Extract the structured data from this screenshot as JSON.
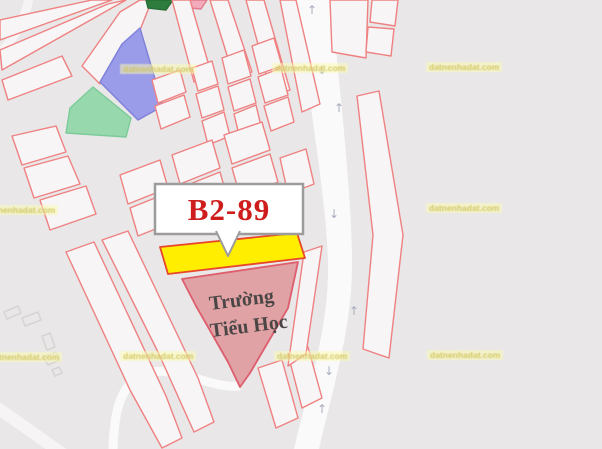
{
  "map": {
    "background_color": "#e9e7e8",
    "parcel_fill": "#f7f5f6",
    "parcel_stroke": "#ef8181",
    "road_color": "#fbfafb",
    "labels": {
      "plot_label": {
        "text": "B2-89",
        "color": "#ce1d1c",
        "box_border_color": "#9c9c9c"
      },
      "school_label": {
        "line1": "Trường",
        "line2": "Tiểu Học",
        "color": "#4b4646"
      }
    },
    "highlight_colors": {
      "selected_parcel_yellow": "#ffee00",
      "school_parcel_pink": "#e0a2a4",
      "parcel_blue": "#9a9be9",
      "parcel_green": "#97d8ac",
      "parcel_dark_green": "#2e7d3e",
      "parcel_pink_sliver": "#f3aabb"
    },
    "arrow_color": "#a8adbe",
    "arrows": [
      {
        "x": 312,
        "y": 14,
        "g": "↑"
      },
      {
        "x": 322,
        "y": 74,
        "g": "↓"
      },
      {
        "x": 339,
        "y": 112,
        "g": "↑"
      },
      {
        "x": 334,
        "y": 218,
        "g": "↓"
      },
      {
        "x": 354,
        "y": 315,
        "g": "↑"
      },
      {
        "x": 329,
        "y": 375,
        "g": "↓"
      },
      {
        "x": 322,
        "y": 413,
        "g": "↑"
      }
    ],
    "watermark": {
      "text": "datnenhadat.com",
      "color": "rgba(206,196,90,0.9)",
      "background": "rgba(252,250,178,0.55)",
      "positions": [
        {
          "x": 120,
          "y": 64
        },
        {
          "x": 272,
          "y": 63
        },
        {
          "x": 426,
          "y": 62
        },
        {
          "x": -18,
          "y": 205
        },
        {
          "x": 426,
          "y": 203
        },
        {
          "x": -14,
          "y": 352
        },
        {
          "x": 120,
          "y": 351
        },
        {
          "x": 274,
          "y": 351
        },
        {
          "x": 427,
          "y": 350
        }
      ]
    },
    "shapes": [
      {
        "name": "road-main",
        "d": "M297,0 L331,0 C341,100 353,210 352,270 C351,333 331,395 319,449 L294,449 C307,392 327,336 328,273 C329,212 308,100 297,0 Z",
        "fill": "#fbfafb",
        "stroke": "none",
        "w": 0,
        "i": false
      },
      {
        "name": "road-curvy",
        "d": "M240,386 C210,390 168,360 140,376 C118,388 114,418 113,449",
        "fill": "none",
        "stroke": "#fbfafb",
        "w": 9,
        "i": false
      },
      {
        "name": "road-bottom-left",
        "d": "M-8,404 L66,456",
        "fill": "none",
        "stroke": "#f6f4f5",
        "w": 12,
        "i": false
      },
      {
        "name": "road-top-left",
        "d": "M-8,62 C12,42 26,22 30,-8",
        "fill": "none",
        "stroke": "#f6f4f5",
        "w": 9,
        "i": false
      },
      {
        "name": "parcel-strip",
        "points": "0,20 92,0 112,0 0,40",
        "i": true
      },
      {
        "name": "parcel-strip",
        "points": "0,50 108,4 126,0 2,70",
        "i": true
      },
      {
        "name": "parcel-strip",
        "points": "2,80 62,56 72,76 8,100",
        "i": true
      },
      {
        "name": "parcel-strip",
        "points": "82,66 120,12 140,0 152,0 140,30 100,84",
        "i": true
      },
      {
        "name": "parcel-green",
        "points": "70,108 93,87 131,118 126,137 66,133",
        "fill": "#97d8ac",
        "stroke": "#7ccb9a",
        "i": true
      },
      {
        "name": "parcel-blue",
        "points": "100,82 122,44 140,28 163,106 138,120",
        "fill": "#9a9be9",
        "stroke": "#7f81da",
        "i": true
      },
      {
        "name": "parcel-dark-green",
        "points": "146,0 173,0 166,10 148,8",
        "fill": "#2e7d3e",
        "stroke": "#276d36",
        "i": true
      },
      {
        "name": "parcel-pink-sliver",
        "points": "177,0 207,0 201,9 179,7",
        "fill": "#f3aabb",
        "stroke": "#e27b8f",
        "i": true
      },
      {
        "name": "parcel-strip",
        "points": "172,0 190,0 212,76 194,82",
        "i": true
      },
      {
        "name": "parcel-strip",
        "points": "210,0 228,0 252,72 234,78",
        "i": true
      },
      {
        "name": "parcel-strip",
        "points": "246,0 264,0 290,90 272,96",
        "i": true
      },
      {
        "name": "parcel-strip",
        "points": "280,0 296,0 320,104 302,112",
        "i": true
      },
      {
        "name": "parcel",
        "points": "152,80 180,70 186,92 158,103",
        "i": true
      },
      {
        "name": "parcel",
        "points": "155,106 184,95 190,117 161,129",
        "i": true
      },
      {
        "name": "parcel",
        "points": "192,68 212,61 218,84 198,91",
        "i": true
      },
      {
        "name": "parcel",
        "points": "196,94 218,86 224,110 202,118",
        "i": true
      },
      {
        "name": "parcel",
        "points": "202,121 224,112 230,136 208,145",
        "i": true
      },
      {
        "name": "parcel",
        "points": "222,58 244,50 251,76 228,84",
        "i": true
      },
      {
        "name": "parcel",
        "points": "228,87 250,79 256,103 234,111",
        "i": true
      },
      {
        "name": "parcel",
        "points": "234,114 256,105 262,130 240,139",
        "i": true
      },
      {
        "name": "parcel",
        "points": "252,46 274,38 282,66 259,74",
        "i": true
      },
      {
        "name": "parcel",
        "points": "258,77 281,68 288,95 265,103",
        "i": true
      },
      {
        "name": "parcel",
        "points": "264,106 288,97 294,122 271,131",
        "i": true
      },
      {
        "name": "parcel",
        "points": "280,158 306,149 314,184 288,194",
        "i": true
      },
      {
        "name": "parcel",
        "points": "120,175 160,160 168,188 128,204",
        "i": true
      },
      {
        "name": "parcel",
        "points": "130,208 170,192 178,220 138,236",
        "i": true
      },
      {
        "name": "parcel",
        "points": "172,155 212,140 220,168 180,184",
        "i": true
      },
      {
        "name": "parcel",
        "points": "180,188 220,172 228,200 188,216",
        "i": true
      },
      {
        "name": "parcel",
        "points": "224,135 262,122 270,150 232,164",
        "i": true
      },
      {
        "name": "parcel",
        "points": "232,168 270,154 278,182 240,196",
        "i": true
      },
      {
        "name": "parcel",
        "points": "12,136 56,126 66,152 22,165",
        "i": true
      },
      {
        "name": "parcel",
        "points": "24,168 68,156 80,184 34,198",
        "i": true
      },
      {
        "name": "parcel",
        "points": "40,200 86,186 96,214 50,230",
        "i": true
      },
      {
        "name": "parcel-strip",
        "points": "66,252 94,242 166,396 182,438 162,448 130,390",
        "i": true
      },
      {
        "name": "parcel-strip",
        "points": "102,240 128,231 198,378 214,422 194,432 158,352",
        "i": true
      },
      {
        "name": "parcel-strip",
        "points": "258,368 282,360 298,418 276,428",
        "i": true
      },
      {
        "name": "parcel-strip",
        "points": "288,354 308,347 322,398 302,408",
        "i": true
      },
      {
        "name": "parcel-strip",
        "points": "304,252 322,246 306,354 288,366",
        "i": true
      },
      {
        "name": "parcel",
        "points": "330,0 368,0 366,58 332,52",
        "i": true
      },
      {
        "name": "parcel",
        "points": "372,0 398,0 395,26 370,22",
        "i": true
      },
      {
        "name": "parcel",
        "points": "368,27 394,29 391,56 366,52",
        "i": true
      },
      {
        "name": "parcel-strip",
        "points": "357,96 379,91 403,235 389,358 363,349 373,235",
        "i": true
      },
      {
        "name": "parcel-school",
        "points": "182,279 298,262 288,308 250,373 240,387 228,362 196,306",
        "fill": "#e0a2a4",
        "stroke": "#de5e6d",
        "w": 1.8,
        "i": true
      },
      {
        "name": "parcel-highlight-b2-89",
        "points": "160,247 297,233 305,258 168,274",
        "fill": "#ffee00",
        "stroke": "#e8472b",
        "w": 1.8,
        "i": true
      },
      {
        "name": "building-footprint",
        "points": "4,312 18,306 21,313 7,319",
        "fill": "none",
        "stroke": "#d8d4d4",
        "w": 1.5,
        "i": false
      },
      {
        "name": "building-footprint",
        "points": "22,318 38,312 41,320 25,326",
        "fill": "none",
        "stroke": "#d8d4d4",
        "w": 1.5,
        "i": false
      },
      {
        "name": "building-footprint",
        "points": "42,336 50,333 55,347 47,350",
        "fill": "none",
        "stroke": "#d8d4d4",
        "w": 1.5,
        "i": false
      },
      {
        "name": "building-footprint",
        "points": "44,357 56,352 60,360 48,365",
        "fill": "none",
        "stroke": "#d8d4d4",
        "w": 1.5,
        "i": false
      },
      {
        "name": "building-footprint",
        "points": "52,370 59,367 62,373 55,376",
        "fill": "none",
        "stroke": "#d8d4d4",
        "w": 1.5,
        "i": false
      }
    ]
  }
}
